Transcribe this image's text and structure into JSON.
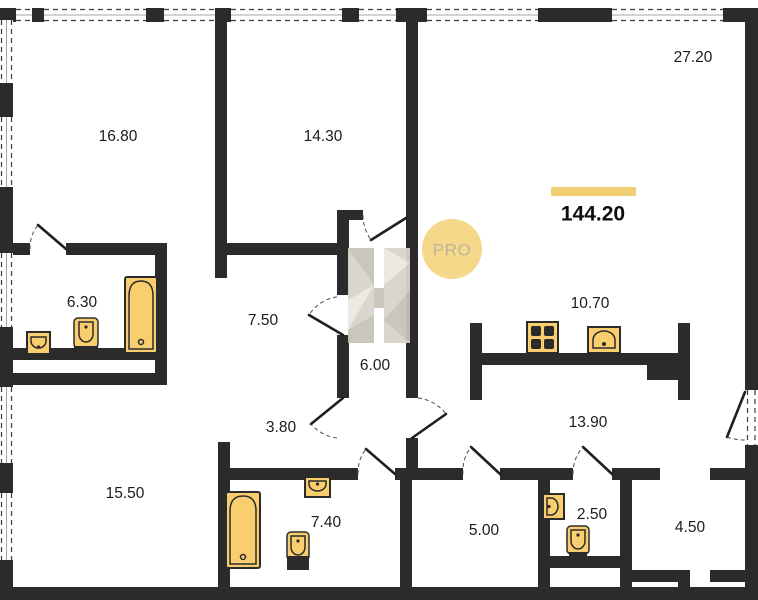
{
  "plan": {
    "total_area": {
      "value": "144.20"
    },
    "badge": {
      "label": "PRO"
    },
    "watermark": {
      "letter": "H"
    },
    "rooms": [
      {
        "name": "bedroom-large",
        "area": "16.80"
      },
      {
        "name": "bedroom",
        "area": "14.30"
      },
      {
        "name": "living-room",
        "area": "27.20"
      },
      {
        "name": "bathroom-ensuite",
        "area": "6.30"
      },
      {
        "name": "corridor",
        "area": "7.50"
      },
      {
        "name": "hallway-center",
        "area": "6.00"
      },
      {
        "name": "kitchen",
        "area": "10.70"
      },
      {
        "name": "passage",
        "area": "3.80"
      },
      {
        "name": "hall",
        "area": "13.90"
      },
      {
        "name": "bedroom-bottom",
        "area": "15.50"
      },
      {
        "name": "bathroom",
        "area": "7.40"
      },
      {
        "name": "storage",
        "area": "5.00"
      },
      {
        "name": "wc",
        "area": "2.50"
      },
      {
        "name": "loggia",
        "area": "4.50"
      }
    ],
    "fixtures": [
      {
        "icon": "bathtub-icon",
        "room": "6.30"
      },
      {
        "icon": "toilet-icon",
        "room": "6.30"
      },
      {
        "icon": "sink-icon",
        "room": "6.30"
      },
      {
        "icon": "stove-icon",
        "room": "10.70"
      },
      {
        "icon": "sink-icon",
        "room": "10.70"
      },
      {
        "icon": "bathtub-icon",
        "room": "7.40"
      },
      {
        "icon": "sink-icon",
        "room": "7.40"
      },
      {
        "icon": "toilet-icon",
        "room": "7.40"
      },
      {
        "icon": "sink-icon",
        "room": "2.50"
      },
      {
        "icon": "toilet-icon",
        "room": "2.50"
      }
    ],
    "colors": {
      "wall": "#2b2b2b",
      "fixture_fill": "#F9CE6E",
      "fixture_stroke": "#2b2b2b",
      "accent_bar": "#F0CF72",
      "badge_fill": "#F5D88A",
      "badge_text": "#BDB49D",
      "text": "#1c1c1c",
      "background": "#ffffff"
    }
  }
}
